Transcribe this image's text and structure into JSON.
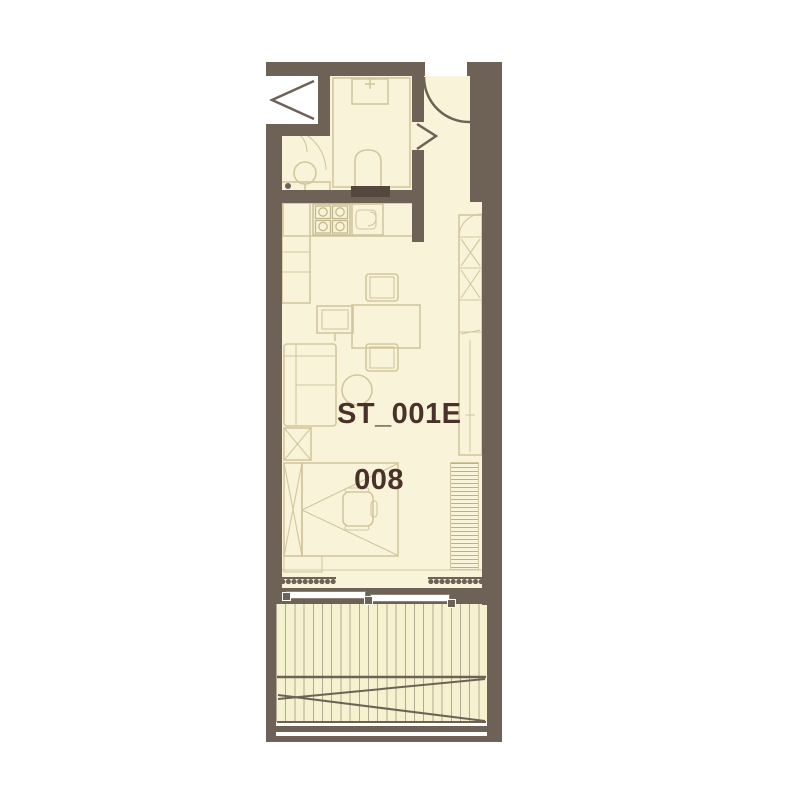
{
  "unit_label": {
    "line1": "ST_001E",
    "line2": "008"
  },
  "colors": {
    "wall": "#6e6257",
    "floor": "#f9f4d9",
    "furniture_line": "#d2c69e",
    "accent_text": "#4a322a",
    "background": "#ffffff",
    "deck_line": "#8d8370"
  }
}
